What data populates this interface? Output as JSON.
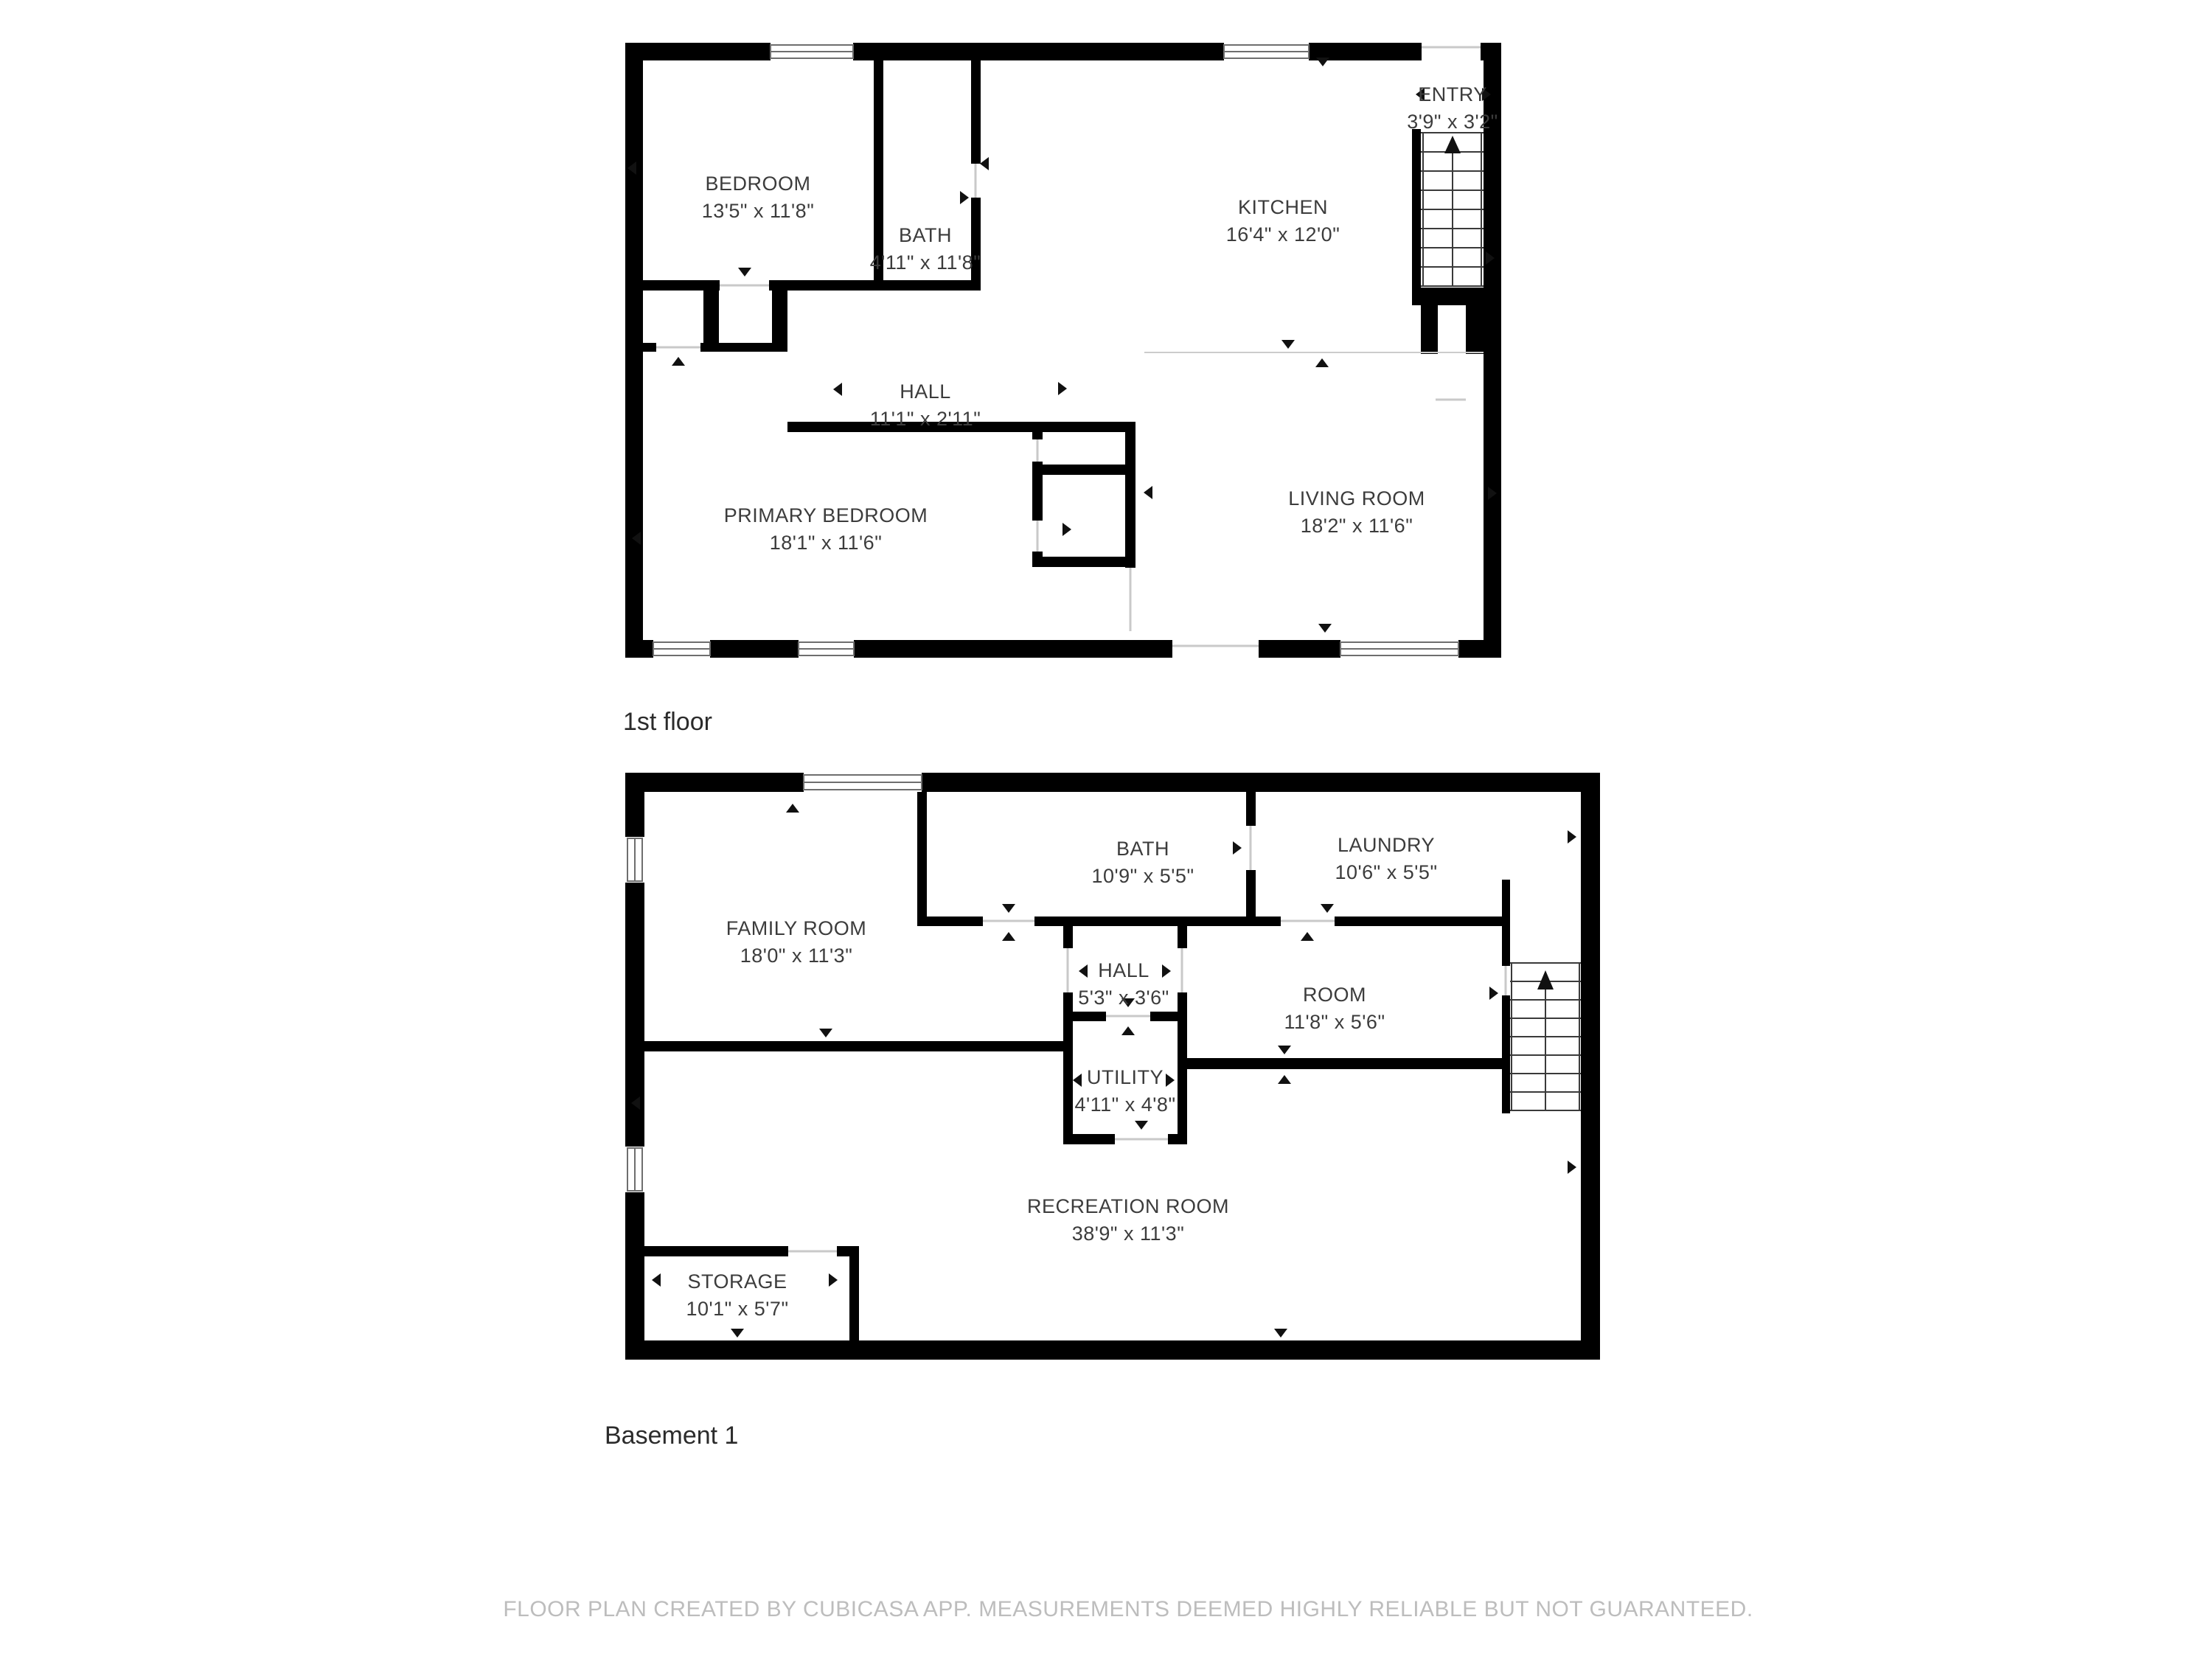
{
  "colors": {
    "wall": "#000000",
    "background": "#ffffff",
    "room_label": "#3c3c3c",
    "floor_label": "#2b2b2b",
    "footer": "#bdbdbd"
  },
  "floors": [
    {
      "id": "first-floor",
      "label": "1st floor",
      "rooms": [
        {
          "name": "BEDROOM",
          "dims": "13'5\" x 11'8\""
        },
        {
          "name": "BATH",
          "dims": "4'11\" x 11'8\""
        },
        {
          "name": "KITCHEN",
          "dims": "16'4\" x 12'0\""
        },
        {
          "name": "ENTRY",
          "dims": "3'9\" x 3'2\""
        },
        {
          "name": "HALL",
          "dims": "11'1\" x 2'11\""
        },
        {
          "name": "PRIMARY BEDROOM",
          "dims": "18'1\" x 11'6\""
        },
        {
          "name": "LIVING ROOM",
          "dims": "18'2\" x 11'6\""
        }
      ]
    },
    {
      "id": "basement-1",
      "label": "Basement 1",
      "rooms": [
        {
          "name": "FAMILY ROOM",
          "dims": "18'0\" x 11'3\""
        },
        {
          "name": "BATH",
          "dims": "10'9\" x 5'5\""
        },
        {
          "name": "LAUNDRY",
          "dims": "10'6\" x 5'5\""
        },
        {
          "name": "HALL",
          "dims": "5'3\" x 3'6\""
        },
        {
          "name": "ROOM",
          "dims": "11'8\" x 5'6\""
        },
        {
          "name": "UTILITY",
          "dims": "4'11\" x 4'8\""
        },
        {
          "name": "RECREATION ROOM",
          "dims": "38'9\" x 11'3\""
        },
        {
          "name": "STORAGE",
          "dims": "10'1\" x 5'7\""
        }
      ]
    }
  ],
  "footer": {
    "text": "FLOOR PLAN CREATED BY CUBICASA APP. MEASUREMENTS DEEMED HIGHLY RELIABLE BUT NOT GUARANTEED."
  }
}
